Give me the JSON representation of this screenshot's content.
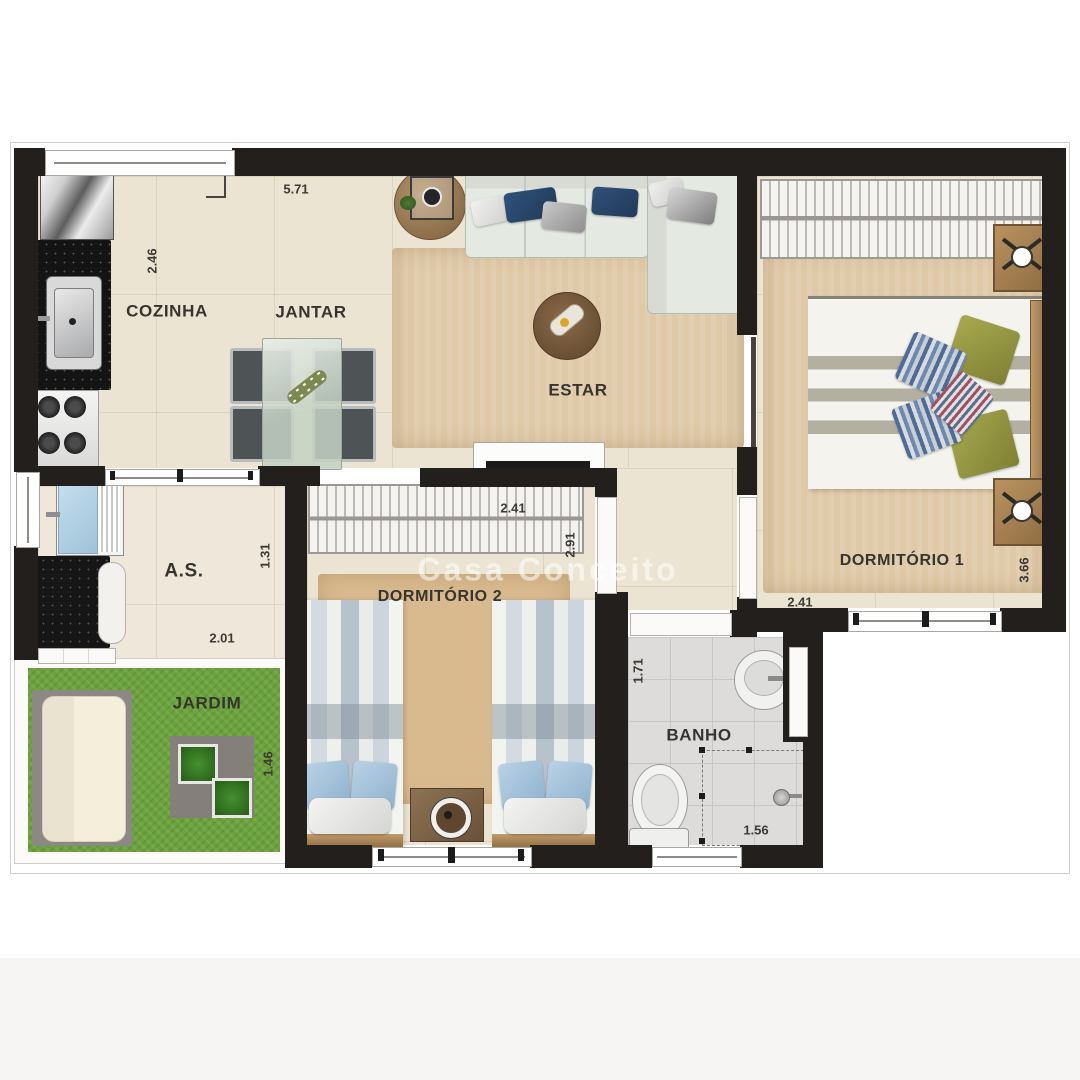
{
  "watermark": "Casa Conceito",
  "labels": {
    "cozinha": "COZINHA",
    "jantar": "JANTAR",
    "estar": "ESTAR",
    "dormitorio1": "DORMITÓRIO 1",
    "dormitorio2": "DORMITÓRIO 2",
    "area_servico": "A.S.",
    "jardim": "JARDIM",
    "banho": "BANHO"
  },
  "dimensions": {
    "sala_largura": "5.71",
    "cozinha_profundidade": "2.46",
    "dormitorio1_largura": "2.41",
    "dormitorio1_profundidade": "3.66",
    "dormitorio2_largura": "2.41",
    "dormitorio2_profundidade": "2.91",
    "area_servico_profundidade": "1.31",
    "area_servico_largura": "2.01",
    "jardim_profundidade": "1.46",
    "banho_profundidade": "1.71",
    "banho_largura": "1.56"
  },
  "colors": {
    "wall": "#221f1c",
    "floor": "#ece4d2",
    "rug": "#dfc9a7",
    "grass": "#6aa23c",
    "sofa": "#e4e9e1",
    "pillow_navy": "#2a4668",
    "pillow_olive": "#9a9b45",
    "bath_floor": "#dddcda",
    "laundry_blue": "#b7d6e8"
  }
}
